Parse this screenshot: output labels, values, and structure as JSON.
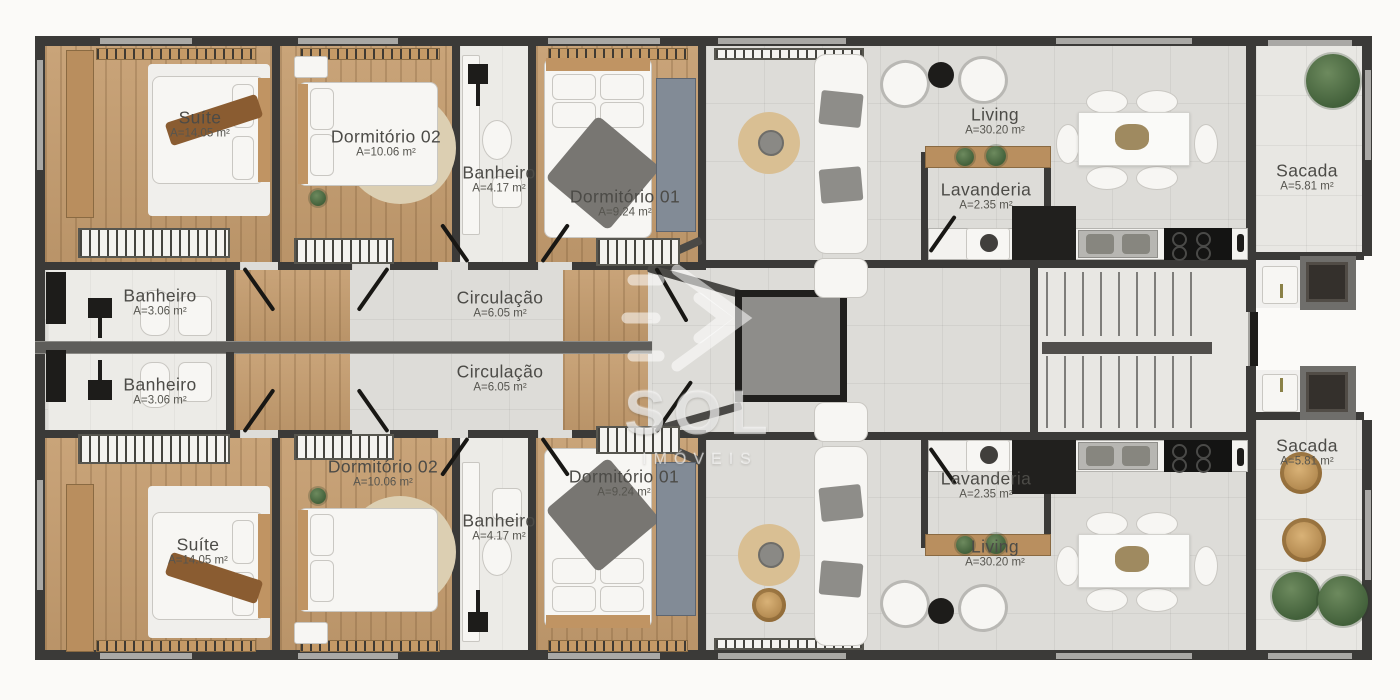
{
  "watermark": {
    "brand": "SOL",
    "brand_sub": "IMÓVEIS"
  },
  "rooms": [
    {
      "id": "suite-top",
      "label": "Suíte",
      "area": "A=14.05 m²"
    },
    {
      "id": "dormitorio-02-top",
      "label": "Dormitório 02",
      "area": "A=10.06 m²"
    },
    {
      "id": "banheiro-top",
      "label": "Banheiro",
      "area": "A=4.17 m²"
    },
    {
      "id": "dormitorio-01-top",
      "label": "Dormitório 01",
      "area": "A=9.24 m²"
    },
    {
      "id": "banheiro-social-top",
      "label": "Banheiro",
      "area": "A=3.06 m²"
    },
    {
      "id": "circulacao-top",
      "label": "Circulação",
      "area": "A=6.05 m²"
    },
    {
      "id": "living-top",
      "label": "Living",
      "area": "A=30.20 m²"
    },
    {
      "id": "lavanderia-top",
      "label": "Lavanderia",
      "area": "A=2.35 m²"
    },
    {
      "id": "sacada-top",
      "label": "Sacada",
      "area": "A=5.81 m²"
    },
    {
      "id": "banheiro-social-bottom",
      "label": "Banheiro",
      "area": "A=3.06 m²"
    },
    {
      "id": "circulacao-bottom",
      "label": "Circulação",
      "area": "A=6.05 m²"
    },
    {
      "id": "dormitorio-02-bottom",
      "label": "Dormitório 02",
      "area": "A=10.06 m²"
    },
    {
      "id": "suite-bottom",
      "label": "Suíte",
      "area": "A=14.05 m²"
    },
    {
      "id": "banheiro-bottom",
      "label": "Banheiro",
      "area": "A=4.17 m²"
    },
    {
      "id": "dormitorio-01-bottom",
      "label": "Dormitório 01",
      "area": "A=9.24 m²"
    },
    {
      "id": "lavanderia-bottom",
      "label": "Lavanderia",
      "area": "A=2.35 m²"
    },
    {
      "id": "living-bottom",
      "label": "Living",
      "area": "A=30.20 m²"
    },
    {
      "id": "sacada-bottom",
      "label": "Sacada",
      "area": "A=5.81 m²"
    }
  ]
}
